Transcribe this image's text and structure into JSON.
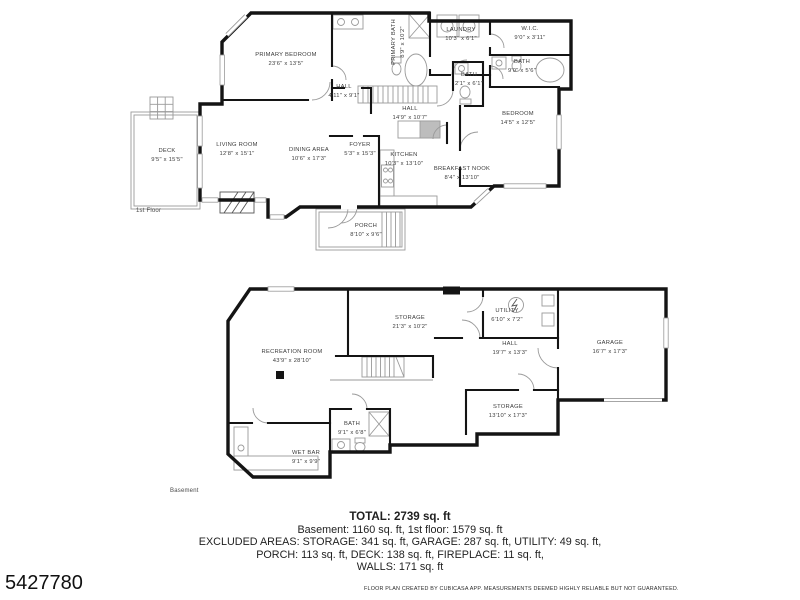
{
  "meta": {
    "listing_id": "5427780",
    "disclaimer": "FLOOR PLAN CREATED BY CUBICASA APP. MEASUREMENTS DEEMED HIGHLY RELIABLE BUT NOT GUARANTEED."
  },
  "summary": {
    "total": "TOTAL: 2739 sq. ft",
    "floors": "Basement: 1160 sq. ft, 1st floor: 1579 sq. ft",
    "excluded1": "EXCLUDED AREAS: STORAGE: 341 sq. ft, GARAGE: 287 sq. ft, UTILITY: 49 sq. ft,",
    "excluded2": "PORCH: 113 sq. ft, DECK: 138 sq. ft, FIREPLACE: 11 sq. ft,",
    "excluded3": "WALLS: 171 sq. ft"
  },
  "floor1": {
    "label": "1st Floor",
    "rooms": [
      {
        "name": "PRIMARY BEDROOM",
        "dims": "23'6\" x 13'5\""
      },
      {
        "name": "PRIMARY BATH",
        "dims": "8'9\" x 10'2\""
      },
      {
        "name": "LAUNDRY",
        "dims": "10'3\" x 6'1\""
      },
      {
        "name": "W.I.C.",
        "dims": "9'0\" x 3'11\""
      },
      {
        "name": "BATH",
        "dims": "9'0\" x 5'6\""
      },
      {
        "name": "BATH",
        "dims": "2'1\" x 6'1\""
      },
      {
        "name": "HALL",
        "dims": "4'11\" x 9'1\""
      },
      {
        "name": "HALL",
        "dims": "14'9\" x 10'7\""
      },
      {
        "name": "BEDROOM",
        "dims": "14'5\" x 12'5\""
      },
      {
        "name": "FOYER",
        "dims": "5'3\" x 15'3\""
      },
      {
        "name": "DINING AREA",
        "dims": "10'6\" x 17'3\""
      },
      {
        "name": "LIVING ROOM",
        "dims": "12'8\" x 15'1\""
      },
      {
        "name": "DECK",
        "dims": "9'5\" x 15'5\""
      },
      {
        "name": "KITCHEN",
        "dims": "10'3\" x 13'10\""
      },
      {
        "name": "BREAKFAST NOOK",
        "dims": "8'4\" x 13'10\""
      },
      {
        "name": "PORCH",
        "dims": "8'10\" x 9'6\""
      }
    ]
  },
  "basement": {
    "label": "Basement",
    "rooms": [
      {
        "name": "RECREATION ROOM",
        "dims": "43'9\" x 28'10\""
      },
      {
        "name": "STORAGE",
        "dims": "21'3\" x 10'2\""
      },
      {
        "name": "UTILITY",
        "dims": "6'10\" x 7'2\""
      },
      {
        "name": "HALL",
        "dims": "19'7\" x 13'3\""
      },
      {
        "name": "GARAGE",
        "dims": "16'7\" x 17'3\""
      },
      {
        "name": "STORAGE",
        "dims": "13'10\" x 17'3\""
      },
      {
        "name": "BATH",
        "dims": "9'1\" x 6'8\""
      },
      {
        "name": "WET BAR",
        "dims": "9'1\" x 9'9\""
      }
    ]
  },
  "colors": {
    "wall": "#141414",
    "thin_line": "#9a9a9a",
    "text": "#3c3c3c"
  }
}
